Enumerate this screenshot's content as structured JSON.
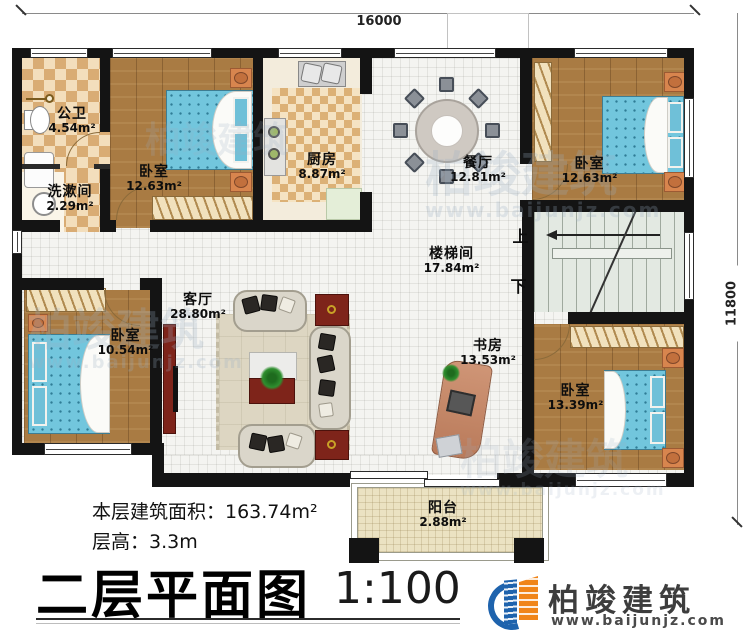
{
  "plan": {
    "dimensions": {
      "width_label": "16000",
      "height_label": "11800"
    },
    "rooms": [
      {
        "id": "bathroom",
        "name": "公卫",
        "area": "4.54m²"
      },
      {
        "id": "washroom",
        "name": "洗漱间",
        "area": "2.29m²"
      },
      {
        "id": "bedroom-top-left",
        "name": "卧室",
        "area": "12.63m²"
      },
      {
        "id": "kitchen",
        "name": "厨房",
        "area": "8.87m²"
      },
      {
        "id": "dining-room",
        "name": "餐厅",
        "area": "12.81m²"
      },
      {
        "id": "bedroom-top-right",
        "name": "卧室",
        "area": "12.63m²"
      },
      {
        "id": "stairwell",
        "name": "楼梯间",
        "area": "17.84m²"
      },
      {
        "id": "living-room",
        "name": "客厅",
        "area": "28.80m²"
      },
      {
        "id": "bedroom-bottom-left",
        "name": "卧室",
        "area": "10.54m²"
      },
      {
        "id": "study",
        "name": "书房",
        "area": "13.53m²"
      },
      {
        "id": "bedroom-bottom-right",
        "name": "卧室",
        "area": "13.39m²"
      },
      {
        "id": "balcony",
        "name": "阳台",
        "area": "2.88m²"
      }
    ],
    "stairs": {
      "up_label": "上",
      "down_label": "下"
    }
  },
  "footer": {
    "floor_area_label": "本层建筑面积：163.74m²",
    "floor_height_label": "层高：3.3m",
    "title": "二层平面图",
    "scale": "1:100"
  },
  "branding": {
    "company_name": "柏竣建筑",
    "website": "www.baijunjz.com"
  },
  "watermark": {
    "text": "柏竣建筑",
    "site": "www.baijunjz.com"
  },
  "colors": {
    "wall": "#141414",
    "wood_floor": "#a97b43",
    "tile": "#e9d3a8",
    "bed_blue": "#72c6dd",
    "accent_red": "#7e241a",
    "stair_floor": "#e3e9e2",
    "balcony_floor": "#ebe2c2",
    "logo_blue": "#1e63ad",
    "logo_orange": "#f08519"
  }
}
